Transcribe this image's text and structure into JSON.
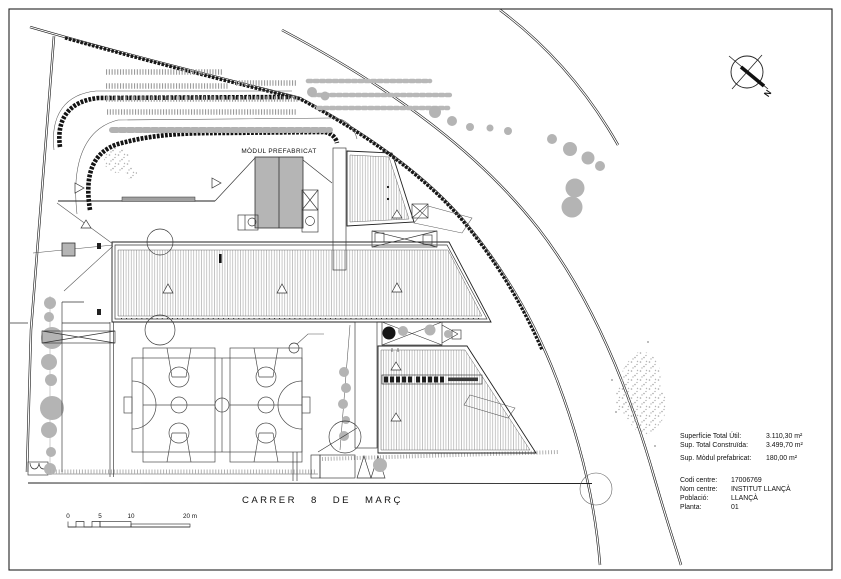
{
  "sheet": {
    "labels": {
      "modul": "MÒDUL PREFABRICAT",
      "street": "CARRER 8 DE MARÇ",
      "north": "N"
    },
    "areas": [
      {
        "label": "Superfície Total Útil:",
        "value": "3.110,30 m²"
      },
      {
        "label": "Sup. Total Construïda:",
        "value": "3.499,70 m²"
      },
      {
        "label": "Sup. Mòdul prefabricat:",
        "value": "180,00 m²"
      }
    ],
    "centre": [
      {
        "label": "Codi centre:",
        "value": "17006769"
      },
      {
        "label": "Nom centre:",
        "value": "INSTITUT LLANÇÀ"
      },
      {
        "label": "Població:",
        "value": "LLANÇÀ"
      },
      {
        "label": "Planta:",
        "value": "01"
      }
    ],
    "scale": {
      "ticks": [
        "0",
        "5",
        "10",
        "20 m"
      ]
    },
    "colors": {
      "ink": "#1a1a1a",
      "gray_fill": "#b5b5b5",
      "hatch": "#9a9a9a"
    }
  }
}
